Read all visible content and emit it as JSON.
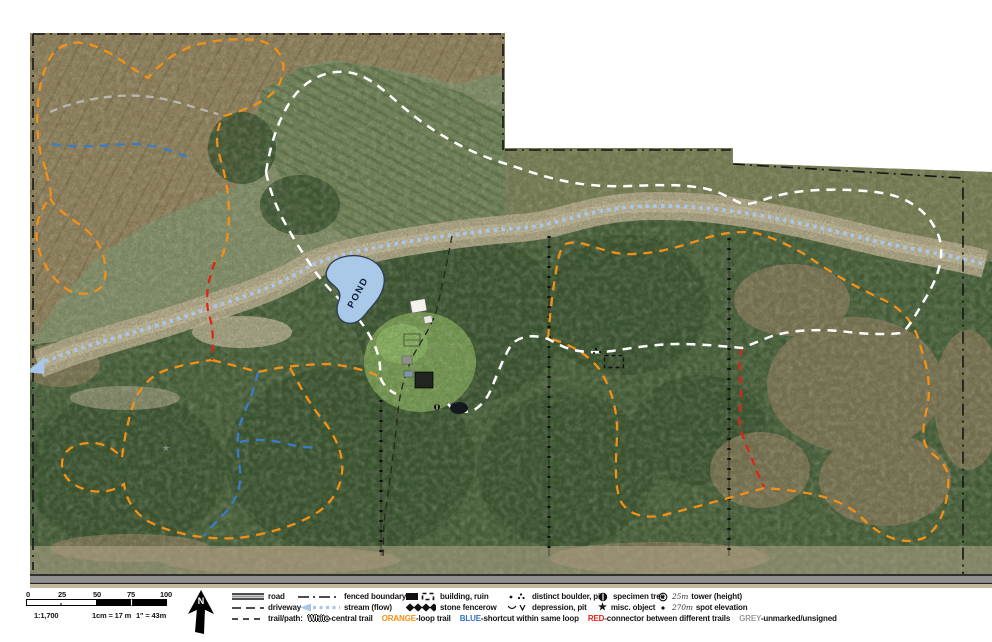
{
  "map": {
    "pond_label": "POND",
    "north_label": "N"
  },
  "colors": {
    "trail_white": "#ffffff",
    "trail_orange": "#F39016",
    "trail_blue": "#3A7CC8",
    "trail_red": "#E02318",
    "trail_grey": "#B8B6B2",
    "stream_blue": "#A7C6E8",
    "boundary_black": "#151515",
    "pond_fill": "#AAC8E8"
  },
  "scalebar": {
    "ticks": [
      "0",
      "25",
      "50",
      "75",
      "100"
    ],
    "ratio": "1:1,700",
    "metric": "1cm = 17 m",
    "imperial": "1\" = 43m"
  },
  "legend": {
    "road": "road",
    "driveway": "driveway",
    "trail_path": "trail/path:",
    "fenced_boundary": "fenced boundary",
    "stream": "stream (flow)",
    "building_ruin": "building, ruin",
    "stone_fencerow": "stone fencerow",
    "boulder": "distinct boulder, pile",
    "depression": "depression, pit",
    "specimen_tree": "specimen tree",
    "misc_object": "misc. object",
    "tower": "tower (height)",
    "tower_value": "25m",
    "spot_elevation": "spot elevation",
    "spot_value": "270m",
    "trails": [
      {
        "label": "White",
        "desc": "-central trail",
        "color": "#ffffff",
        "outline": true
      },
      {
        "label": "ORANGE",
        "desc": "-loop trail",
        "color": "#F39016"
      },
      {
        "label": "BLUE",
        "desc": "-shortcut within same loop",
        "color": "#2E74C9"
      },
      {
        "label": "RED",
        "desc": "-connector between different trails",
        "color": "#E02318"
      },
      {
        "label": "GREY",
        "desc": "-unmarked/unsigned",
        "color": "#9A9A98"
      }
    ]
  }
}
